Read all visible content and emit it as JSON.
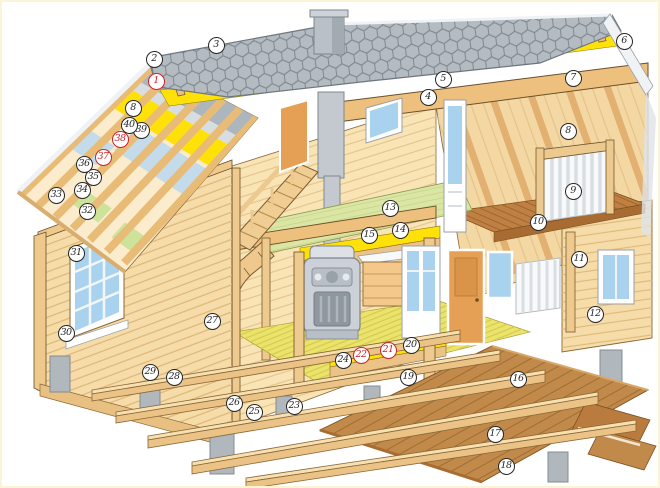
{
  "figure": {
    "type": "cutaway-house-construction-diagram",
    "subject": "two-storey timber house with numbered building components"
  },
  "palette": {
    "paper": "#ffffff",
    "frame": "#fbf5d6",
    "marker_black": "#262626",
    "marker_red": "#cf2127",
    "roof_gray": "#b4bbc1",
    "roof_line": "#7f8891",
    "trim_white": "#f0f3f5",
    "wood_light": "#f6dca8",
    "wood_mid": "#ecc386",
    "wood_beam": "#edc07e",
    "wood_outline": "#6b4f2a",
    "insulation_yellow": "#ffe10a",
    "floor_green": "#dbe6a4",
    "straw_yellow": "#ebe36a",
    "window_blue": "#a9d2ee",
    "deck_brown": "#c28a4a",
    "deck_dark": "#a86c32",
    "concrete_gray": "#b0b7bd",
    "stove_gray": "#ccd1d7"
  },
  "markers": [
    {
      "label": "1",
      "x": 156,
      "y": 81,
      "red": true
    },
    {
      "label": "2",
      "x": 154,
      "y": 59
    },
    {
      "label": "3",
      "x": 216,
      "y": 45
    },
    {
      "label": "4",
      "x": 428,
      "y": 97
    },
    {
      "label": "5",
      "x": 443,
      "y": 79
    },
    {
      "label": "6",
      "x": 624,
      "y": 41
    },
    {
      "label": "7",
      "x": 573,
      "y": 78
    },
    {
      "label": "8",
      "x": 568,
      "y": 131
    },
    {
      "label": "8",
      "x": 133,
      "y": 108
    },
    {
      "label": "9",
      "x": 573,
      "y": 191
    },
    {
      "label": "10",
      "x": 538,
      "y": 222
    },
    {
      "label": "11",
      "x": 579,
      "y": 259
    },
    {
      "label": "12",
      "x": 595,
      "y": 314
    },
    {
      "label": "13",
      "x": 390,
      "y": 208
    },
    {
      "label": "14",
      "x": 400,
      "y": 230
    },
    {
      "label": "15",
      "x": 369,
      "y": 235
    },
    {
      "label": "16",
      "x": 518,
      "y": 379
    },
    {
      "label": "17",
      "x": 495,
      "y": 434
    },
    {
      "label": "18",
      "x": 506,
      "y": 466
    },
    {
      "label": "19",
      "x": 408,
      "y": 377
    },
    {
      "label": "20",
      "x": 411,
      "y": 345
    },
    {
      "label": "21",
      "x": 388,
      "y": 350,
      "red": true
    },
    {
      "label": "22",
      "x": 361,
      "y": 355,
      "red": true
    },
    {
      "label": "23",
      "x": 294,
      "y": 406
    },
    {
      "label": "24",
      "x": 343,
      "y": 360
    },
    {
      "label": "25",
      "x": 254,
      "y": 412
    },
    {
      "label": "26",
      "x": 234,
      "y": 403
    },
    {
      "label": "27",
      "x": 212,
      "y": 321
    },
    {
      "label": "28",
      "x": 174,
      "y": 377
    },
    {
      "label": "29",
      "x": 150,
      "y": 372
    },
    {
      "label": "30",
      "x": 66,
      "y": 333
    },
    {
      "label": "31",
      "x": 76,
      "y": 253
    },
    {
      "label": "32",
      "x": 87,
      "y": 211
    },
    {
      "label": "33",
      "x": 56,
      "y": 195
    },
    {
      "label": "34",
      "x": 82,
      "y": 190
    },
    {
      "label": "35",
      "x": 93,
      "y": 177
    },
    {
      "label": "36",
      "x": 84,
      "y": 164
    },
    {
      "label": "37",
      "x": 103,
      "y": 157,
      "red": true
    },
    {
      "label": "38",
      "x": 120,
      "y": 139,
      "red": true
    },
    {
      "label": "39",
      "x": 141,
      "y": 130
    },
    {
      "label": "40",
      "x": 129,
      "y": 125
    }
  ]
}
